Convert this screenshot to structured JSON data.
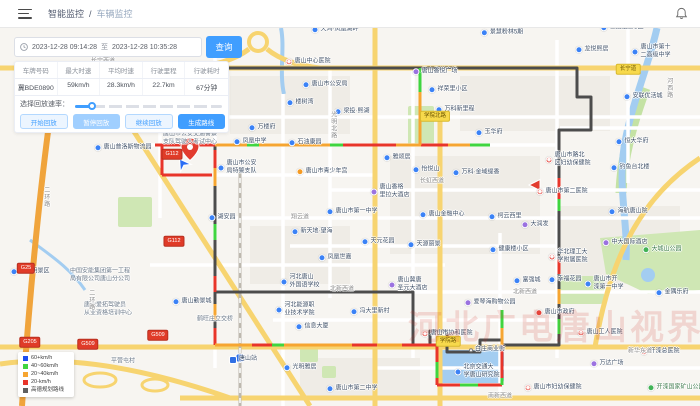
{
  "header": {
    "breadcrumb": {
      "parent": "智能监控",
      "separator": "/",
      "current": "车辆监控"
    }
  },
  "toolbar": {
    "date_start": "2023-12-28 09:14:28",
    "date_separator": "至",
    "date_end": "2023-12-28 10:35:28",
    "query_label": "查询"
  },
  "stats": {
    "headers": [
      "车牌号码",
      "最大时速",
      "平均时速",
      "行驶里程",
      "行驶耗时"
    ],
    "values": [
      "冀BDE0890",
      "59km/h",
      "28.3km/h",
      "22.7km",
      "67分钟"
    ]
  },
  "playback": {
    "rate_label": "选择回放速率：",
    "buttons": [
      {
        "label": "开始回放",
        "style": "outline"
      },
      {
        "label": "暂停回放",
        "style": "disabled"
      },
      {
        "label": "继续回放",
        "style": "outline"
      },
      {
        "label": "生成路线",
        "style": "primary"
      }
    ]
  },
  "legend": {
    "items": [
      {
        "color": "#1d4ff2",
        "label": "60+km/h"
      },
      {
        "color": "#3fd53f",
        "label": "40~60km/h"
      },
      {
        "color": "#f6a531",
        "label": "20~40km/h"
      },
      {
        "color": "#e8352a",
        "label": "20-km/h"
      },
      {
        "color": "#5f5f5f",
        "label": "高德规划路线"
      }
    ]
  },
  "map": {
    "watermark": "河北广电唐山视界",
    "labels": [
      {
        "t": "poi",
        "x": 335,
        "y": 30,
        "text": "天鸿·凤凰湖畔"
      },
      {
        "t": "poi",
        "x": 502,
        "y": 33,
        "text": "景慧粉林5期"
      },
      {
        "t": "poi",
        "x": 622,
        "y": 28,
        "text": "世纪龙庭C区"
      },
      {
        "t": "poi",
        "x": 592,
        "y": 50,
        "text": "龙悦熙居"
      },
      {
        "t": "poi",
        "x": 325,
        "y": 85,
        "text": "唐山市公安局"
      },
      {
        "t": "poi",
        "x": 448,
        "y": 90,
        "text": "祥荣里小区"
      },
      {
        "t": "poi",
        "x": 643,
        "y": 97,
        "text": "安联优活城"
      },
      {
        "t": "poi",
        "x": 300,
        "y": 103,
        "text": "楼树湾"
      },
      {
        "t": "poi",
        "x": 455,
        "y": 110,
        "text": "万科新里程"
      },
      {
        "t": "poi",
        "x": 352,
        "y": 112,
        "text": "梁投·熙湖"
      },
      {
        "t": "poi",
        "x": 262,
        "y": 128,
        "text": "万楼府"
      },
      {
        "t": "poi",
        "x": 305,
        "y": 143,
        "text": "石油康园"
      },
      {
        "t": "poi",
        "x": 489,
        "y": 133,
        "text": "玉华府"
      },
      {
        "t": "poi",
        "x": 632,
        "y": 142,
        "text": "恒大华府"
      },
      {
        "t": "poi",
        "x": 123,
        "y": 148,
        "text": "唐山普洛斯物流园"
      },
      {
        "t": "poi",
        "x": 630,
        "y": 168,
        "text": "钓鱼台北楼"
      },
      {
        "t": "poi",
        "x": 397,
        "y": 158,
        "text": "雅颂居"
      },
      {
        "t": "poi",
        "x": 476,
        "y": 173,
        "text": "万科·金域缇香"
      },
      {
        "t": "poi",
        "x": 426,
        "y": 170,
        "text": "怡悦山"
      },
      {
        "t": "poi",
        "x": 237,
        "y": 168,
        "text": "唐山市公安\n局特警支队"
      },
      {
        "t": "poi",
        "x": 222,
        "y": 218,
        "text": "湖安园"
      },
      {
        "t": "poi",
        "x": 628,
        "y": 212,
        "text": "海航唐山院"
      },
      {
        "t": "poi",
        "x": 442,
        "y": 215,
        "text": "唐山金融中心"
      },
      {
        "t": "poi",
        "x": 505,
        "y": 217,
        "text": "柯云西里"
      },
      {
        "t": "poi",
        "x": 312,
        "y": 232,
        "text": "新天地·望海"
      },
      {
        "t": "poi",
        "x": 509,
        "y": 250,
        "text": "健康楼小区"
      },
      {
        "t": "poi",
        "x": 378,
        "y": 242,
        "text": "天元花园"
      },
      {
        "t": "poi",
        "x": 424,
        "y": 245,
        "text": "天源丽景"
      },
      {
        "t": "poi",
        "x": 335,
        "y": 258,
        "text": "凤凰世嘉"
      },
      {
        "t": "poi",
        "x": 565,
        "y": 280,
        "text": "幸福花园"
      },
      {
        "t": "poi",
        "x": 527,
        "y": 281,
        "text": "富强城"
      },
      {
        "t": "poi",
        "x": 672,
        "y": 293,
        "text": "金隅乐府"
      },
      {
        "t": "poi",
        "x": 370,
        "y": 312,
        "text": "冯大里新村"
      },
      {
        "t": "poi",
        "x": 312,
        "y": 327,
        "text": "信息大厦"
      },
      {
        "t": "poi",
        "x": 300,
        "y": 368,
        "text": "光明雅居"
      },
      {
        "t": "poi",
        "x": 30,
        "y": 272,
        "text": "鼎旺明景区"
      },
      {
        "t": "poi",
        "x": 192,
        "y": 302,
        "text": "唐山勤景城"
      },
      {
        "t": "school",
        "x": 250,
        "y": 142,
        "text": "凤凰中学"
      },
      {
        "t": "school",
        "x": 352,
        "y": 212,
        "text": "唐山市第一中学"
      },
      {
        "t": "school",
        "x": 352,
        "y": 389,
        "text": "唐山市第二中学"
      },
      {
        "t": "school",
        "x": 651,
        "y": 52,
        "text": "唐山市第十\n二高级中学"
      },
      {
        "t": "school",
        "x": 300,
        "y": 282,
        "text": "河北唐山\n外国语学校"
      },
      {
        "t": "school",
        "x": 604,
        "y": 284,
        "text": "唐山市开\n滦第一中学"
      },
      {
        "t": "school",
        "x": 295,
        "y": 310,
        "text": "河北能源职\n业技术学院"
      },
      {
        "t": "school",
        "x": 477,
        "y": 372,
        "text": "北京交通大\n学唐山研究院"
      },
      {
        "t": "hospital",
        "x": 308,
        "y": 62,
        "text": "唐山中心医院"
      },
      {
        "t": "hospital",
        "x": 568,
        "y": 160,
        "text": "唐山市路北\n区妇幼保健院"
      },
      {
        "t": "hospital",
        "x": 562,
        "y": 192,
        "text": "唐山市第二医院"
      },
      {
        "t": "hospital",
        "x": 568,
        "y": 257,
        "text": "华北理工大\n学附属医院"
      },
      {
        "t": "hospital",
        "x": 447,
        "y": 334,
        "text": "唐山市协和医院"
      },
      {
        "t": "hospital",
        "x": 600,
        "y": 333,
        "text": "唐山工人医院"
      },
      {
        "t": "hospital",
        "x": 660,
        "y": 352,
        "text": "开滦总医院"
      },
      {
        "t": "hospital",
        "x": 553,
        "y": 388,
        "text": "唐山市妇幼保健院"
      },
      {
        "t": "purple",
        "x": 435,
        "y": 72,
        "text": "唐山香悦广场"
      },
      {
        "t": "purple",
        "x": 390,
        "y": 192,
        "text": "唐山香格\n里拉大酒店"
      },
      {
        "t": "purple",
        "x": 535,
        "y": 225,
        "text": "大润发"
      },
      {
        "t": "purple",
        "x": 625,
        "y": 243,
        "text": "中大国际酒店"
      },
      {
        "t": "purple",
        "x": 408,
        "y": 285,
        "text": "唐山冀唐\n圣元大酒店"
      },
      {
        "t": "purple",
        "x": 490,
        "y": 303,
        "text": "爱琴海购物公园"
      },
      {
        "t": "purple",
        "x": 607,
        "y": 364,
        "text": "万达广场"
      },
      {
        "t": "gov",
        "x": 555,
        "y": 313,
        "text": "唐山市政府"
      },
      {
        "t": "org",
        "x": 322,
        "y": 172,
        "text": "唐山市青少年宫"
      },
      {
        "t": "green",
        "x": 662,
        "y": 250,
        "text": "大城山公园"
      },
      {
        "t": "green",
        "x": 676,
        "y": 388,
        "text": "开滦国家矿山公园"
      },
      {
        "t": "station",
        "x": 243,
        "y": 360,
        "text": "唐山站"
      },
      {
        "t": "dot",
        "x": 487,
        "y": 350,
        "text": "白庄商业街"
      },
      {
        "t": "plain",
        "x": 190,
        "y": 139,
        "text": "唐山市公安交通警察\n支队驾驶人考试中心"
      },
      {
        "t": "plain",
        "x": 100,
        "y": 276,
        "text": "中国安能集团第一工程\n局有限公司唐山分公司"
      },
      {
        "t": "plain",
        "x": 108,
        "y": 310,
        "text": "唐山爱拓驾驶员\n从业资格培训中心"
      },
      {
        "t": "plain",
        "x": 215,
        "y": 320,
        "text": "鹤旺庄立交桥"
      },
      {
        "t": "plain",
        "x": 123,
        "y": 362,
        "text": "平营屯村"
      },
      {
        "t": "road",
        "x": 103,
        "y": 62,
        "text": "长宁西道"
      },
      {
        "t": "road",
        "x": 300,
        "y": 218,
        "text": "翔云道"
      },
      {
        "t": "road",
        "x": 432,
        "y": 182,
        "text": "长虹西道"
      },
      {
        "t": "road",
        "x": 342,
        "y": 290,
        "text": "北新西道"
      },
      {
        "t": "road",
        "x": 525,
        "y": 293,
        "text": "北新西道"
      },
      {
        "t": "road",
        "x": 640,
        "y": 352,
        "text": "新华东道"
      },
      {
        "t": "road",
        "x": 500,
        "y": 397,
        "text": "南新西道"
      },
      {
        "t": "roadv",
        "x": 332,
        "y": 125,
        "text": "光明北路"
      },
      {
        "t": "roadv",
        "x": 668,
        "y": 88,
        "text": "河西路"
      },
      {
        "t": "roadv",
        "x": 45,
        "y": 197,
        "text": "二环路"
      },
      {
        "t": "roadv",
        "x": 90,
        "y": 300,
        "text": "二环路"
      }
    ],
    "badges": [
      {
        "kind": "red",
        "x": 172,
        "y": 154,
        "text": "G112"
      },
      {
        "kind": "red",
        "x": 174,
        "y": 241,
        "text": "G112"
      },
      {
        "kind": "red",
        "x": 88,
        "y": 344,
        "text": "G509"
      },
      {
        "kind": "red",
        "x": 158,
        "y": 335,
        "text": "G509"
      },
      {
        "kind": "red",
        "x": 30,
        "y": 342,
        "text": "G205"
      },
      {
        "kind": "red",
        "x": 26,
        "y": 268,
        "text": "G25"
      },
      {
        "kind": "yellow",
        "x": 435,
        "y": 116,
        "text": "学院北路"
      },
      {
        "kind": "yellow",
        "x": 448,
        "y": 341,
        "text": "学院路"
      },
      {
        "kind": "yellow",
        "x": 628,
        "y": 69,
        "text": "长宁道"
      }
    ]
  }
}
